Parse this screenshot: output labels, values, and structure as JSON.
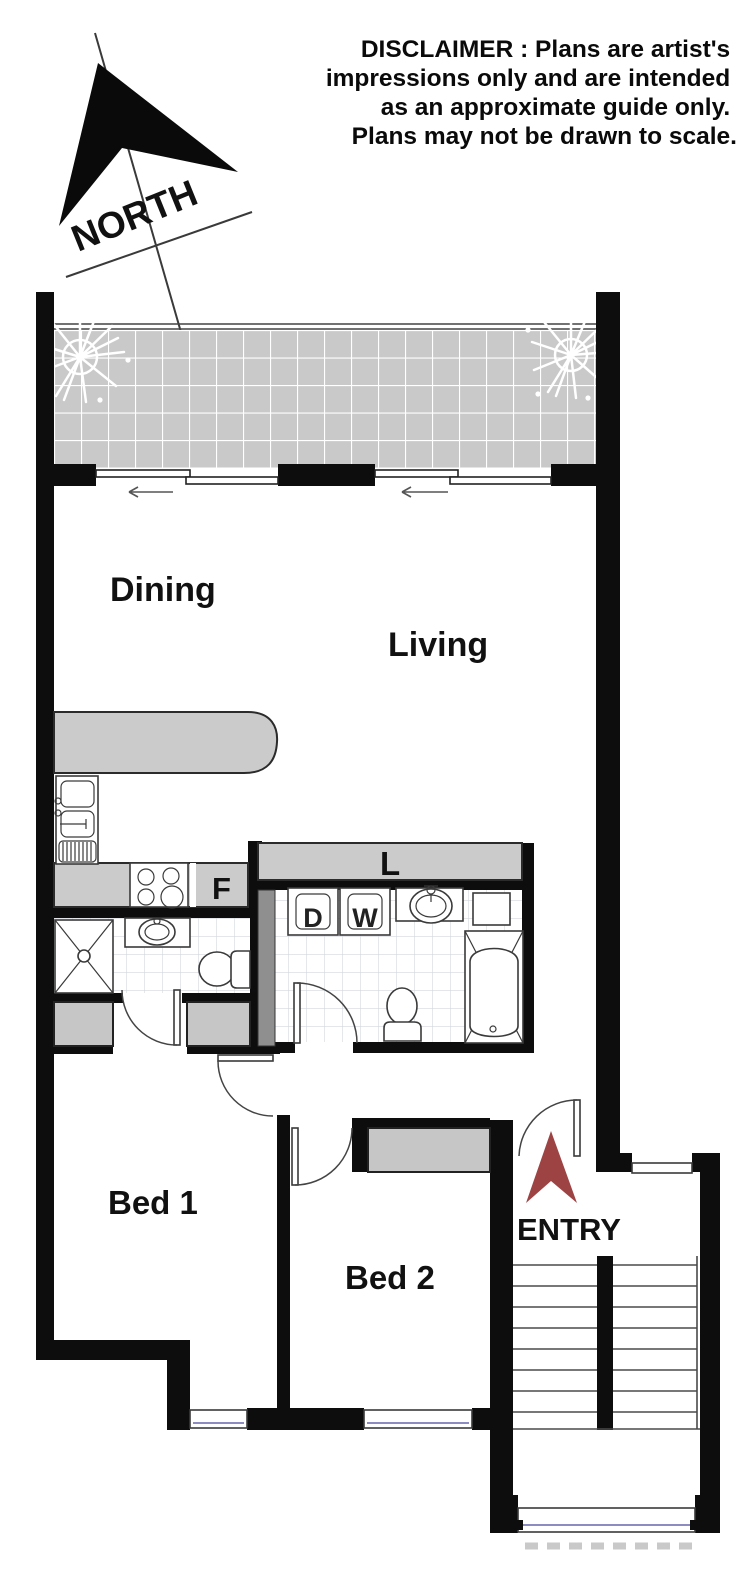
{
  "disclaimer": {
    "lines": [
      "DISCLAIMER : Plans are artist's",
      "impressions only and are intended",
      "as an approximate guide only.",
      "Plans may not be drawn to scale."
    ]
  },
  "compass": {
    "label": "NORTH"
  },
  "rooms": {
    "dining": "Dining",
    "living": "Living",
    "bed1": "Bed 1",
    "bed2": "Bed 2",
    "entry": "ENTRY"
  },
  "fixtures": {
    "fridge": "F",
    "linen": "L",
    "dryer": "D",
    "washer": "W"
  },
  "colors": {
    "wall": "#0d0d0d",
    "balcony_tile": "#c9c9c9",
    "bench_gray": "#cbcbcb",
    "robe_gray": "#c6c6c6",
    "duct_gray": "#8f8f8f",
    "entry_arrow_red": "#9e4343",
    "window_glass_line": "#8c8cc0"
  }
}
